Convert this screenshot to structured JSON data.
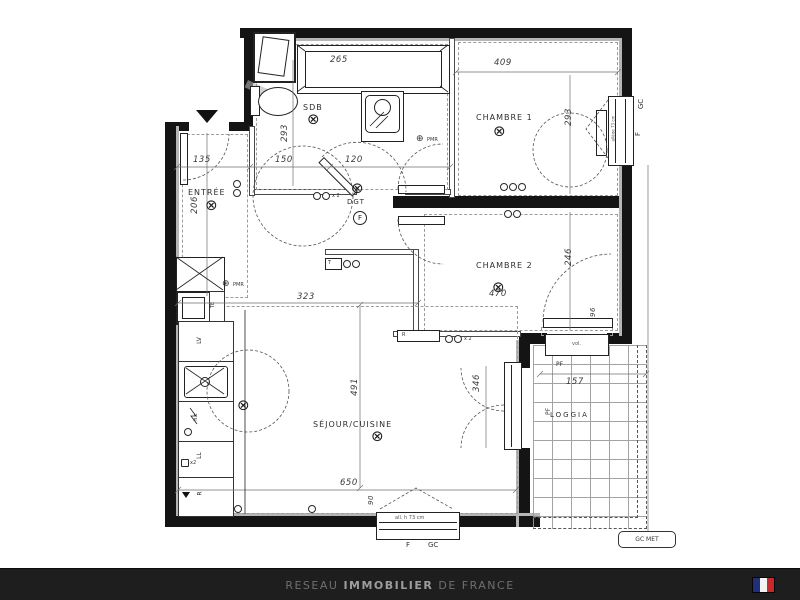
{
  "plan": {
    "rooms": {
      "entree": "ENTRÉE",
      "sdb": "SDB",
      "dgt": "DGT",
      "chambre1": "CHAMBRE 1",
      "chambre2": "CHAMBRE 2",
      "sejour": "SÉJOUR/CUISINE",
      "loggia": "LOGGIA"
    },
    "dims": {
      "bath": "265",
      "ch1_width": "409",
      "ch1_height": "293",
      "sdb_height": "293",
      "entree_width": "135",
      "hall_width": "150",
      "dgt_width": "120",
      "entree_height": "206",
      "ch2_height": "246",
      "ch2_width": "470",
      "sejour_top": "323",
      "sejour_height": "491",
      "sejour_width": "650",
      "pf_height": "346",
      "loggia_width": "157",
      "loggia_door": "96",
      "window_width": "90"
    },
    "labels": {
      "pmr": "PMR",
      "f": "F",
      "gc": "GC",
      "gc_met": "GC MET",
      "pf": "PF",
      "x2": "x 2",
      "x2_kitchen": "x2",
      "vol": "vol.",
      "allege_bottom": "all. h 73 cm",
      "allege_right": "allège 73 cm",
      "te": "TE",
      "lv": "LV",
      "ll": "LL",
      "fridge": "R",
      "radiator": "R",
      "hc": "h.c",
      "thermostat": "T",
      "door_letter": "F"
    },
    "glyphs": {
      "ceiling_light": "⊗",
      "pmr_marker": "⊕"
    }
  },
  "footer": {
    "brand_prefix": "RESEAU",
    "brand_bold": "IMMOBILIER",
    "brand_suffix": "DE FRANCE",
    "bg": "#1e1e1e",
    "text_color": "#6f6f6f",
    "bold_color": "#9d9d9d",
    "flag_colors": [
      "#1f2f7a",
      "#f2f2f2",
      "#c5292e"
    ]
  }
}
